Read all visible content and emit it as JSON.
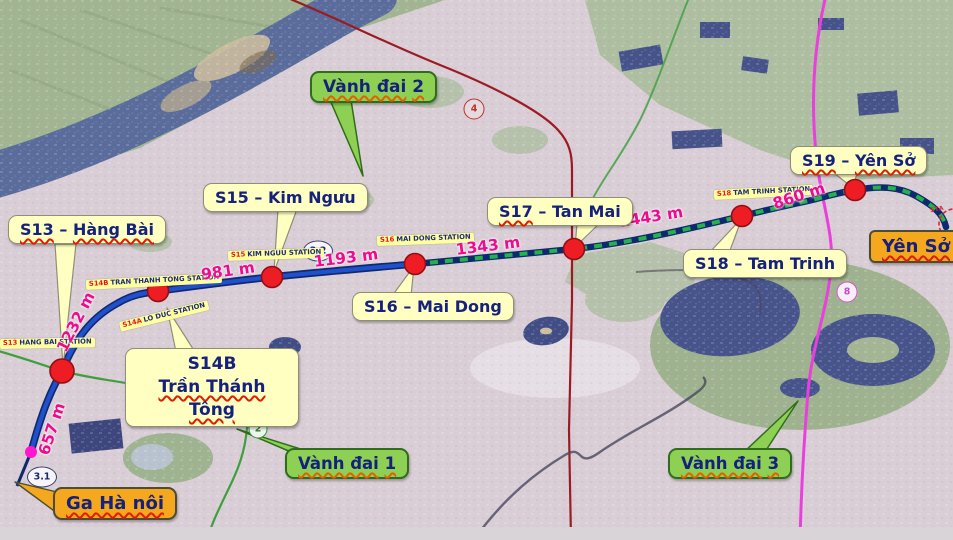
{
  "callouts": {
    "s13": {
      "p1": "S13",
      "sep": " – ",
      "p2": "Hàng Bài"
    },
    "s14b": {
      "line1": "S14B",
      "line2": "Trần Thánh Tông"
    },
    "s15": {
      "p1": "S15",
      "sep": " – ",
      "p2": "Kim Ngưu"
    },
    "s16": {
      "p1": "S16",
      "sep": " – ",
      "p2": "Mai Dong"
    },
    "s17": {
      "p1": "S17",
      "sep": " – ",
      "p2": "Tan Mai"
    },
    "s18": {
      "p1": "S18",
      "sep": " – ",
      "p2": "Tam Trinh"
    },
    "s19": {
      "p1": "S19",
      "sep": " – ",
      "p2": "Yên Sở"
    },
    "ga_hanoi": {
      "label": "Ga Hà nôi"
    },
    "yen_so": {
      "label": "Yên Sở"
    },
    "ring_road_1": {
      "p1": "Vành đai",
      "p2": "1"
    },
    "ring_road_2": {
      "p1": "Vành đai",
      "p2": "2"
    },
    "ring_road_3": {
      "p1": "Vành đai",
      "p2": "3"
    }
  },
  "station_tags": [
    {
      "prefix": "S13",
      "name": "HANG BAI STATION"
    },
    {
      "prefix": "S14B",
      "name": "TRAN THANH TONG STATION"
    },
    {
      "prefix": "S14A",
      "name": "LO DUC STATION"
    },
    {
      "prefix": "S15",
      "name": "KIM NGUU STATION"
    },
    {
      "prefix": "S16",
      "name": "MAI DONG STATION"
    },
    {
      "prefix": "S18",
      "name": "TAM TRINH STATION"
    }
  ],
  "distances": {
    "ga_to_s13": "657 m",
    "s13_to_s14b": "1232 m",
    "s14b_to_s15": "981 m",
    "s15_to_s16": "1193 m",
    "s16_to_s17": "1343 m",
    "s17_to_s18": "1443 m",
    "s18_to_s19": "860 m"
  },
  "road_markers": {
    "m3_1": "3.1",
    "m3_2": "3.2",
    "m2": "2",
    "m4": "4",
    "m8": "8",
    "depot_stub": "STA"
  },
  "colors": {
    "metro_solid_blue": "#2050cc",
    "metro_navy_edge": "#0e2a6e",
    "metro_dash_green": "#25b14b",
    "station_red": "#ee1d23",
    "endpoint_magenta": "#ff17cf",
    "distance_pink": "#ef0a8e",
    "callout_yellow": "#ffffc2",
    "callout_green": "#8ed054",
    "callout_orange": "#f5a71d",
    "ring_road_2_red": "#9c1b23",
    "ring_road_3_magenta": "#e940dd",
    "ring_road_1_green": "#3f9f3f",
    "river_blue": "#5a6c9c"
  }
}
